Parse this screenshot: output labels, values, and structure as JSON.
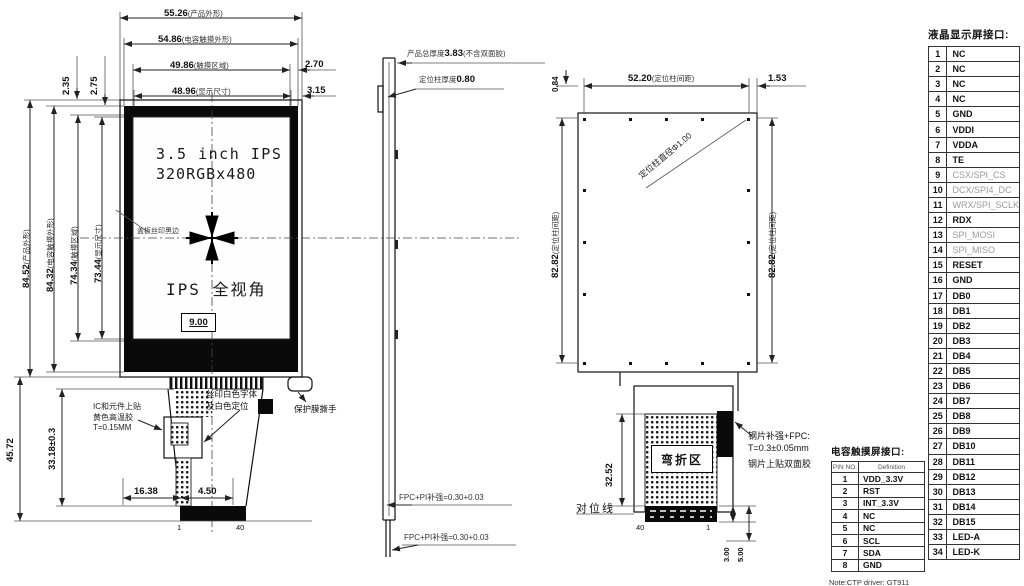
{
  "front_view": {
    "top_dims": [
      {
        "v": "55.26",
        "n": "(产品外形)"
      },
      {
        "v": "54.86",
        "n": "(电容触摸外形)"
      },
      {
        "v": "49.86",
        "n": "(触摸区域)"
      },
      {
        "v": "48.96",
        "n": "(显示尺寸)"
      }
    ],
    "offset_dims": [
      "2.70",
      "3.15"
    ],
    "corner_dims": [
      "2.35",
      "2.75"
    ],
    "left_dims": [
      {
        "v": "84.52",
        "n": "(产品外形)"
      },
      {
        "v": "84.32",
        "n": "(电容触摸外形)"
      },
      {
        "v": "74.34",
        "n": "(触摸区域)"
      },
      {
        "v": "73.44",
        "n": "(显示尺寸)"
      }
    ],
    "screen": {
      "line1": "3.5 inch IPS",
      "line2": "320RGBx480",
      "line3": "IPS 全视角",
      "silk_note": "盖板丝印黑边",
      "center_dim": "9.00"
    },
    "fpc": {
      "height_total": "45.72",
      "height_tail": "33.18±0.3",
      "width_left": "16.38",
      "width_right": "4.50",
      "pin_first": "1",
      "pin_last": "40"
    },
    "notes": {
      "ic": [
        "IC和元件上贴",
        "黄色高温胶",
        "T=0.15MM"
      ],
      "silk": [
        "丝印白色字体",
        "及白色定位"
      ],
      "film": "保护膜撕手"
    }
  },
  "side_view": {
    "thickness": {
      "prefix": "产品总厚度",
      "value": "3.83",
      "suffix": "(不含双面胶)"
    },
    "post": {
      "prefix": "定位柱厚度",
      "value": "0.80"
    },
    "fpc_top": "FPC+PI补强=0.30+0.03",
    "fpc_bottom": "FPC+PI补强=0.30+0.03"
  },
  "back_view": {
    "post_pitch_h": {
      "v": "52.20",
      "n": "(定位柱间距)"
    },
    "edge_dim": "1.53",
    "top_dim": "0.84",
    "post_dia": "定位柱直径Φ1.00",
    "post_pitch_v_left": {
      "v": "82.82",
      "n": "(定位柱间距)"
    },
    "post_pitch_v_right": {
      "v": "82.82",
      "n": "(定位柱间距)"
    },
    "bend_zone": "弯折区",
    "bend_len": "32.52",
    "align_line": "对位线",
    "stiffener": [
      "钢片补强+FPC:",
      "T=0.3±0.05mm",
      "钢片上贴双面胶"
    ],
    "pin_left": "40",
    "pin_right": "1",
    "tail_dims": [
      "3.00",
      "5.00"
    ]
  },
  "lcd_table": {
    "title": "液晶显示屏接口:",
    "rows": [
      {
        "pin": "1",
        "name": "NC"
      },
      {
        "pin": "2",
        "name": "NC"
      },
      {
        "pin": "3",
        "name": "NC"
      },
      {
        "pin": "4",
        "name": "NC"
      },
      {
        "pin": "5",
        "name": "GND"
      },
      {
        "pin": "6",
        "name": "VDDI"
      },
      {
        "pin": "7",
        "name": "VDDA"
      },
      {
        "pin": "8",
        "name": "TE"
      },
      {
        "pin": "9",
        "name": "CSX/SPI_CS",
        "cls": "dim"
      },
      {
        "pin": "10",
        "name": "DCX/SPI4_DC",
        "cls": "dim"
      },
      {
        "pin": "11",
        "name": "WRX/SPI_SCLK",
        "cls": "dim"
      },
      {
        "pin": "12",
        "name": "RDX"
      },
      {
        "pin": "13",
        "name": "SPI_MOSI",
        "cls": "dim"
      },
      {
        "pin": "14",
        "name": "SPI_MISO",
        "cls": "dim"
      },
      {
        "pin": "15",
        "name": "RESET"
      },
      {
        "pin": "16",
        "name": "GND"
      },
      {
        "pin": "17",
        "name": "DB0"
      },
      {
        "pin": "18",
        "name": "DB1"
      },
      {
        "pin": "19",
        "name": "DB2"
      },
      {
        "pin": "20",
        "name": "DB3"
      },
      {
        "pin": "21",
        "name": "DB4"
      },
      {
        "pin": "22",
        "name": "DB5"
      },
      {
        "pin": "23",
        "name": "DB6"
      },
      {
        "pin": "24",
        "name": "DB7"
      },
      {
        "pin": "25",
        "name": "DB8"
      },
      {
        "pin": "26",
        "name": "DB9"
      },
      {
        "pin": "27",
        "name": "DB10"
      },
      {
        "pin": "28",
        "name": "DB11"
      },
      {
        "pin": "29",
        "name": "DB12"
      },
      {
        "pin": "30",
        "name": "DB13"
      },
      {
        "pin": "31",
        "name": "DB14"
      },
      {
        "pin": "32",
        "name": "DB15"
      },
      {
        "pin": "33",
        "name": "LED-A"
      },
      {
        "pin": "34",
        "name": "LED-K"
      }
    ]
  },
  "touch_table": {
    "title": "电容触摸屏接口:",
    "col_pin": "PIN NO.",
    "col_def": "Definition",
    "note": "Note:CTP driver: GT911",
    "rows": [
      {
        "pin": "1",
        "name": "VDD_3.3V"
      },
      {
        "pin": "2",
        "name": "RST"
      },
      {
        "pin": "3",
        "name": "INT_3.3V"
      },
      {
        "pin": "4",
        "name": "NC"
      },
      {
        "pin": "5",
        "name": "NC"
      },
      {
        "pin": "6",
        "name": "SCL"
      },
      {
        "pin": "7",
        "name": "SDA"
      },
      {
        "pin": "8",
        "name": "GND"
      }
    ]
  }
}
